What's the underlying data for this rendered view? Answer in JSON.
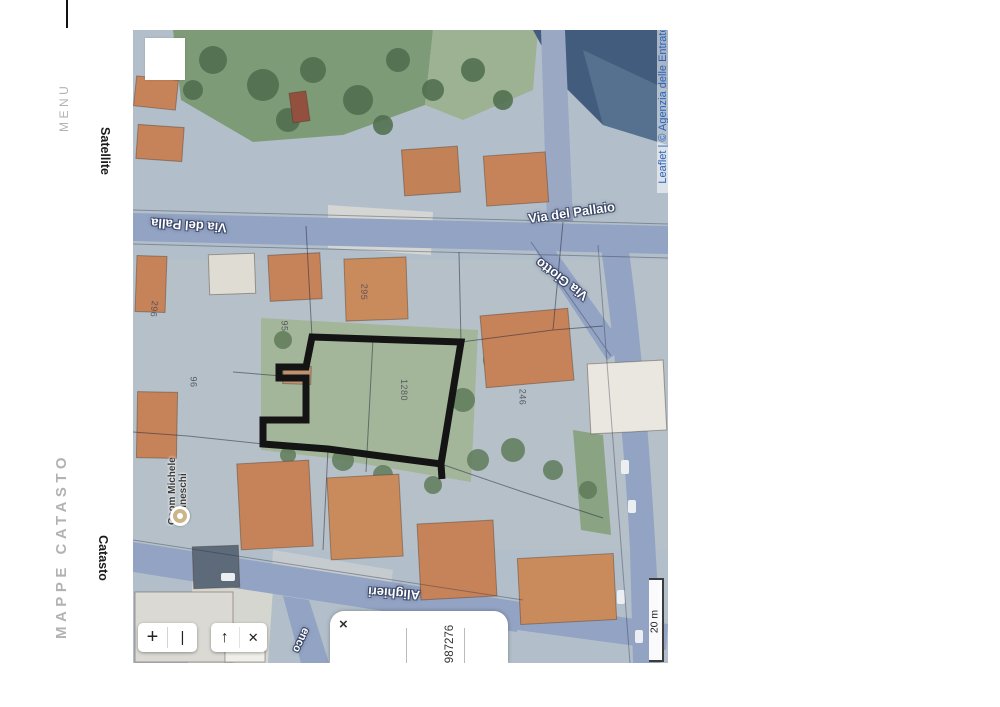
{
  "page": {
    "background": "#ffffff"
  },
  "left_rail": {
    "menu": "MENU",
    "app_title": "MAPPE CATASTO",
    "layer_satellite": "Satellite",
    "layer_catasto": "Catasto"
  },
  "map": {
    "attribution": "Leaflet | © Agenzia delle Entrate",
    "streets": {
      "pallaio": "Via del Pallaio",
      "pallaio_flipped": "Via del Palla",
      "giotto": "Via Giotto",
      "alighieri": "Alighieri",
      "partial": "enco"
    },
    "poi": {
      "line1": "Geom Michele",
      "line2": "Manneschi"
    },
    "parcels": {
      "p296": "296",
      "p295": "295",
      "p95": "95",
      "p96": "96",
      "p1280": "1280",
      "p246": "246"
    },
    "controls": {
      "zoom_in": "+",
      "zoom_out": "|",
      "pan_arrow": "↑",
      "close": "✕",
      "popup_close": "×"
    },
    "popup": {
      "parcel_id": "987276"
    },
    "scale": {
      "label": "20 m"
    },
    "colors": {
      "polygon": "#141414",
      "attribution_blue": "#2a62b9",
      "road": "#93a3c3",
      "roof": "#c6835a"
    }
  }
}
